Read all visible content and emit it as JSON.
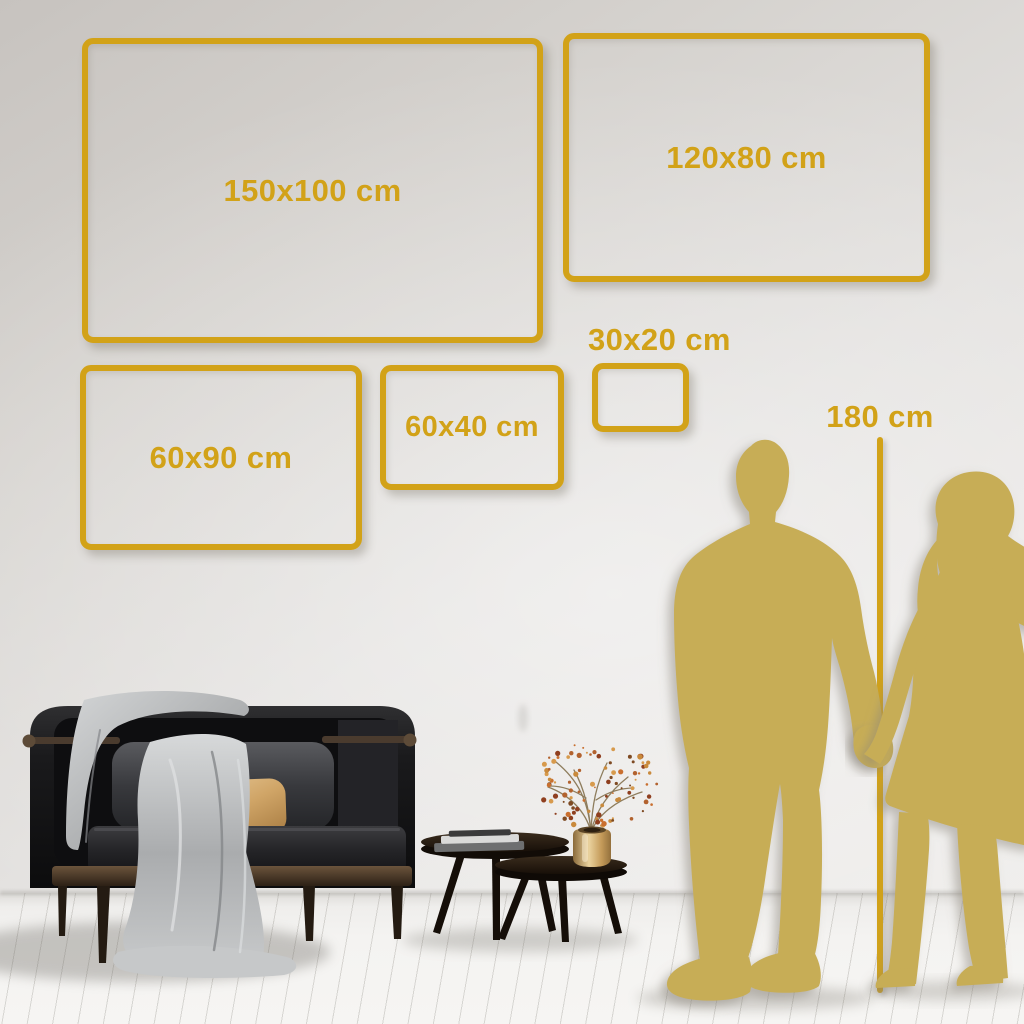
{
  "colors": {
    "accent": "#d2a218",
    "silhouette": "#c7ad57"
  },
  "size_frames": [
    {
      "id": "150x100",
      "label": "150x100 cm"
    },
    {
      "id": "120x80",
      "label": "120x80 cm"
    },
    {
      "id": "60x90",
      "label": "60x90 cm"
    },
    {
      "id": "60x40",
      "label": "60x40 cm"
    },
    {
      "id": "30x20",
      "label": "30x20 cm"
    }
  ],
  "height_marker": {
    "label": "180 cm"
  }
}
